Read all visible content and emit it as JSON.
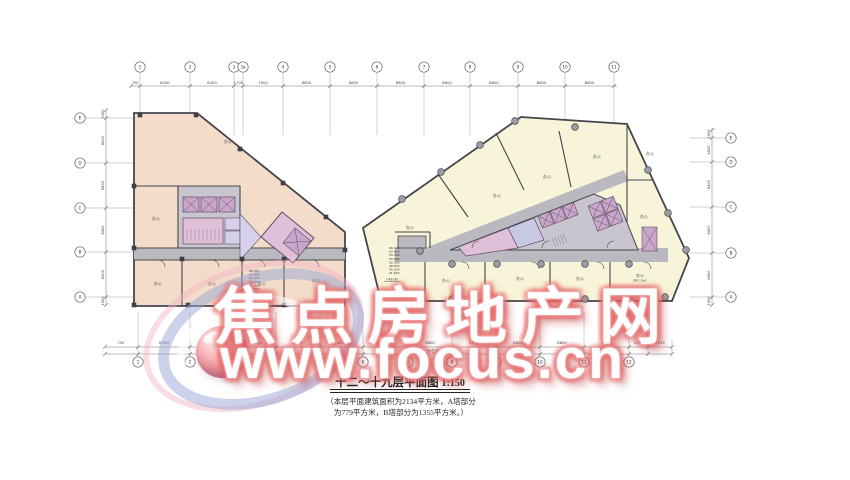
{
  "watermark": {
    "line1": "焦点房地产网",
    "line2": "www.focus.cn"
  },
  "title": {
    "text": "十二～十九层平面图",
    "scale": "1:150"
  },
  "note": {
    "line1": "（本层平面建筑面积为2134平方米，A塔部分",
    "line2": "为779平方米，B塔部分为1355平方米。）"
  },
  "grid": {
    "top": {
      "lead_dim": "750",
      "bubbles": [
        {
          "label": "1",
          "x": 140
        },
        {
          "label": "2",
          "x": 190
        },
        {
          "label": "3",
          "x": 234
        },
        {
          "label": "3a",
          "x": 243
        },
        {
          "label": "4",
          "x": 283
        },
        {
          "label": "5",
          "x": 330
        },
        {
          "label": "6",
          "x": 377
        },
        {
          "label": "7",
          "x": 424
        },
        {
          "label": "8",
          "x": 470
        },
        {
          "label": "9",
          "x": 518
        },
        {
          "label": "10",
          "x": 565
        },
        {
          "label": "11",
          "x": 614
        }
      ],
      "dims": [
        "8200",
        "8400",
        "1700",
        "7500",
        "8800",
        "8800",
        "8800",
        "8800",
        "8800",
        "8800",
        "8800"
      ]
    },
    "bottom": {
      "lead_dim": "750",
      "bubbles": [
        {
          "label": "1",
          "x": 138
        },
        {
          "label": "2",
          "x": 190
        },
        {
          "label": "3",
          "x": 231
        },
        {
          "label": "3a",
          "x": 239
        },
        {
          "label": "4",
          "x": 276
        },
        {
          "label": "5",
          "x": 320
        },
        {
          "label": "6",
          "x": 363
        },
        {
          "label": "7",
          "x": 408
        },
        {
          "label": "8",
          "x": 452
        },
        {
          "label": "9",
          "x": 496
        },
        {
          "label": "10",
          "x": 540
        },
        {
          "label": "11",
          "x": 584
        },
        {
          "label": "12",
          "x": 629
        }
      ],
      "extra_ticks": [
        648,
        672
      ],
      "dims": [
        "8200",
        "8400",
        "1700",
        "7500",
        "8800",
        "8800",
        "8800",
        "8800",
        "8800",
        "8800",
        "8800",
        "8800",
        "1500",
        "2195"
      ],
      "total": "59520"
    },
    "left": {
      "bubbles": [
        {
          "label": "E",
          "y": 118
        },
        {
          "label": "D",
          "y": 163
        },
        {
          "label": "C",
          "y": 208
        },
        {
          "label": "B",
          "y": 252
        },
        {
          "label": "A",
          "y": 297
        }
      ],
      "ticks": [
        110,
        118,
        163,
        208,
        252,
        297,
        305
      ],
      "dims": [
        "1500",
        "8400",
        "8400",
        "8400",
        "8400",
        "1500"
      ]
    },
    "right": {
      "bubbles": [
        {
          "label": "E",
          "y": 138
        },
        {
          "label": "D",
          "y": 162
        },
        {
          "label": "C",
          "y": 207
        },
        {
          "label": "B",
          "y": 253
        },
        {
          "label": "A",
          "y": 297
        }
      ],
      "ticks": [
        130,
        138,
        162,
        207,
        253,
        297,
        305
      ],
      "dims": [
        "1500",
        "4500",
        "8400",
        "8400",
        "8400",
        "1500"
      ]
    }
  },
  "rooms": {
    "tower_a": [
      {
        "t": "办公",
        "x": 228,
        "y": 143
      },
      {
        "t": "办公",
        "x": 156,
        "y": 220
      },
      {
        "t": "办公",
        "x": 158,
        "y": 285
      },
      {
        "t": "办公",
        "x": 212,
        "y": 285
      },
      {
        "t": "办公",
        "x": 262,
        "y": 285
      },
      {
        "t": "办公",
        "x": 316,
        "y": 282
      }
    ],
    "tower_b": [
      {
        "t": "办公",
        "x": 410,
        "y": 229
      },
      {
        "t": "办公",
        "x": 497,
        "y": 197
      },
      {
        "t": "办公",
        "x": 547,
        "y": 178
      },
      {
        "t": "办公",
        "x": 597,
        "y": 158
      },
      {
        "t": "办公",
        "x": 650,
        "y": 155
      },
      {
        "t": "办公",
        "x": 644,
        "y": 218
      },
      {
        "t": "办公",
        "x": 446,
        "y": 282
      },
      {
        "t": "办公",
        "x": 520,
        "y": 280
      },
      {
        "t": "办公",
        "x": 580,
        "y": 280
      },
      {
        "t": "办公",
        "x": 640,
        "y": 277,
        "sub": "88.13㎡"
      }
    ]
  },
  "elevations": {
    "tower_a": {
      "x": 249,
      "y": 272,
      "values": [
        "66.300",
        "62.800",
        "59.300",
        "55.800",
        "52.300",
        "48.800",
        "45.300",
        "41.800"
      ],
      "datum": "43.00"
    },
    "tower_b": {
      "x": 389,
      "y": 249,
      "values": [
        "66.300",
        "62.800",
        "59.300",
        "55.800",
        "52.300",
        "48.800",
        "45.300",
        "41.800"
      ],
      "datum": "43.00"
    }
  },
  "columns": {
    "squares": [
      [
        140,
        115
      ],
      [
        196,
        115
      ],
      [
        240,
        149
      ],
      [
        283,
        183
      ],
      [
        326,
        217
      ],
      [
        134,
        186
      ],
      [
        134,
        248
      ],
      [
        134,
        305
      ],
      [
        182,
        259
      ],
      [
        242,
        259
      ],
      [
        284,
        259
      ],
      [
        188,
        305
      ],
      [
        242,
        305
      ],
      [
        284,
        305
      ],
      [
        340,
        305
      ],
      [
        345,
        250
      ]
    ],
    "circles": [
      [
        402,
        199
      ],
      [
        441,
        172
      ],
      [
        480,
        145
      ],
      [
        515,
        121
      ],
      [
        575,
        127
      ],
      [
        648,
        170
      ],
      [
        668,
        213
      ],
      [
        686,
        250
      ],
      [
        452,
        264
      ],
      [
        497,
        264
      ],
      [
        541,
        264
      ],
      [
        585,
        264
      ],
      [
        629,
        264
      ],
      [
        452,
        299
      ],
      [
        497,
        299
      ],
      [
        541,
        299
      ],
      [
        585,
        299
      ],
      [
        629,
        299
      ],
      [
        665,
        297
      ],
      [
        420,
        251
      ]
    ]
  },
  "colors": {
    "wall": "#45454c",
    "grid_line": "#8b8b90",
    "tower_a": "#f3dcc9",
    "tower_b": "#f8f4d9",
    "corridor": "#b9b9bf",
    "core_gray": "#c9c5ce",
    "core_cell": "#c9a6cb",
    "core_pink": "#dfc0d8",
    "core_blue": "#c9c8e4",
    "core_lav": "#d6d0ea",
    "column_fill": "#9c9ca4",
    "dim_text": "#444444",
    "room_text": "#5a564e"
  }
}
